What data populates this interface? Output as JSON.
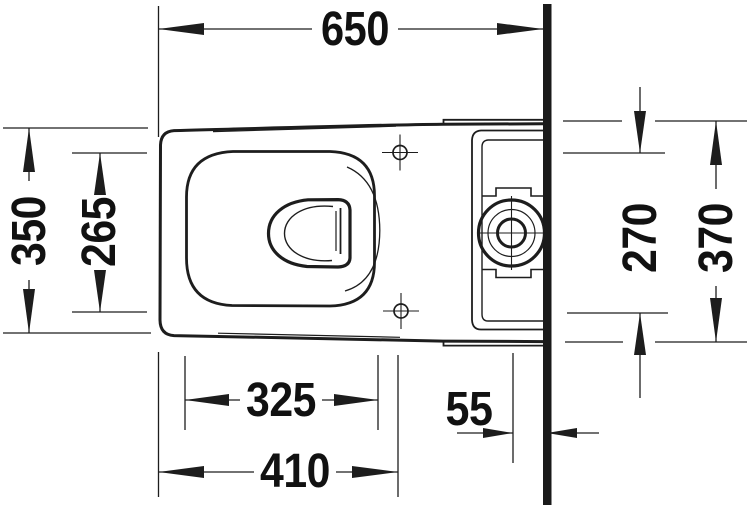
{
  "meta": {
    "title": "Toilet installation technical drawing – plan view",
    "units": "mm"
  },
  "drawing": {
    "background": "#ffffff",
    "line_color": "#1d1d1d",
    "wall_color": "#1a1a1a",
    "dimensions": {
      "overall_depth": "650",
      "body_width": "350",
      "seat_opening_width": "265",
      "seat_opening_depth": "325",
      "front_to_fixing_holes": "410",
      "outlet_center_to_wall": "55",
      "tank_recess_width": "270",
      "tank_width": "370"
    }
  }
}
